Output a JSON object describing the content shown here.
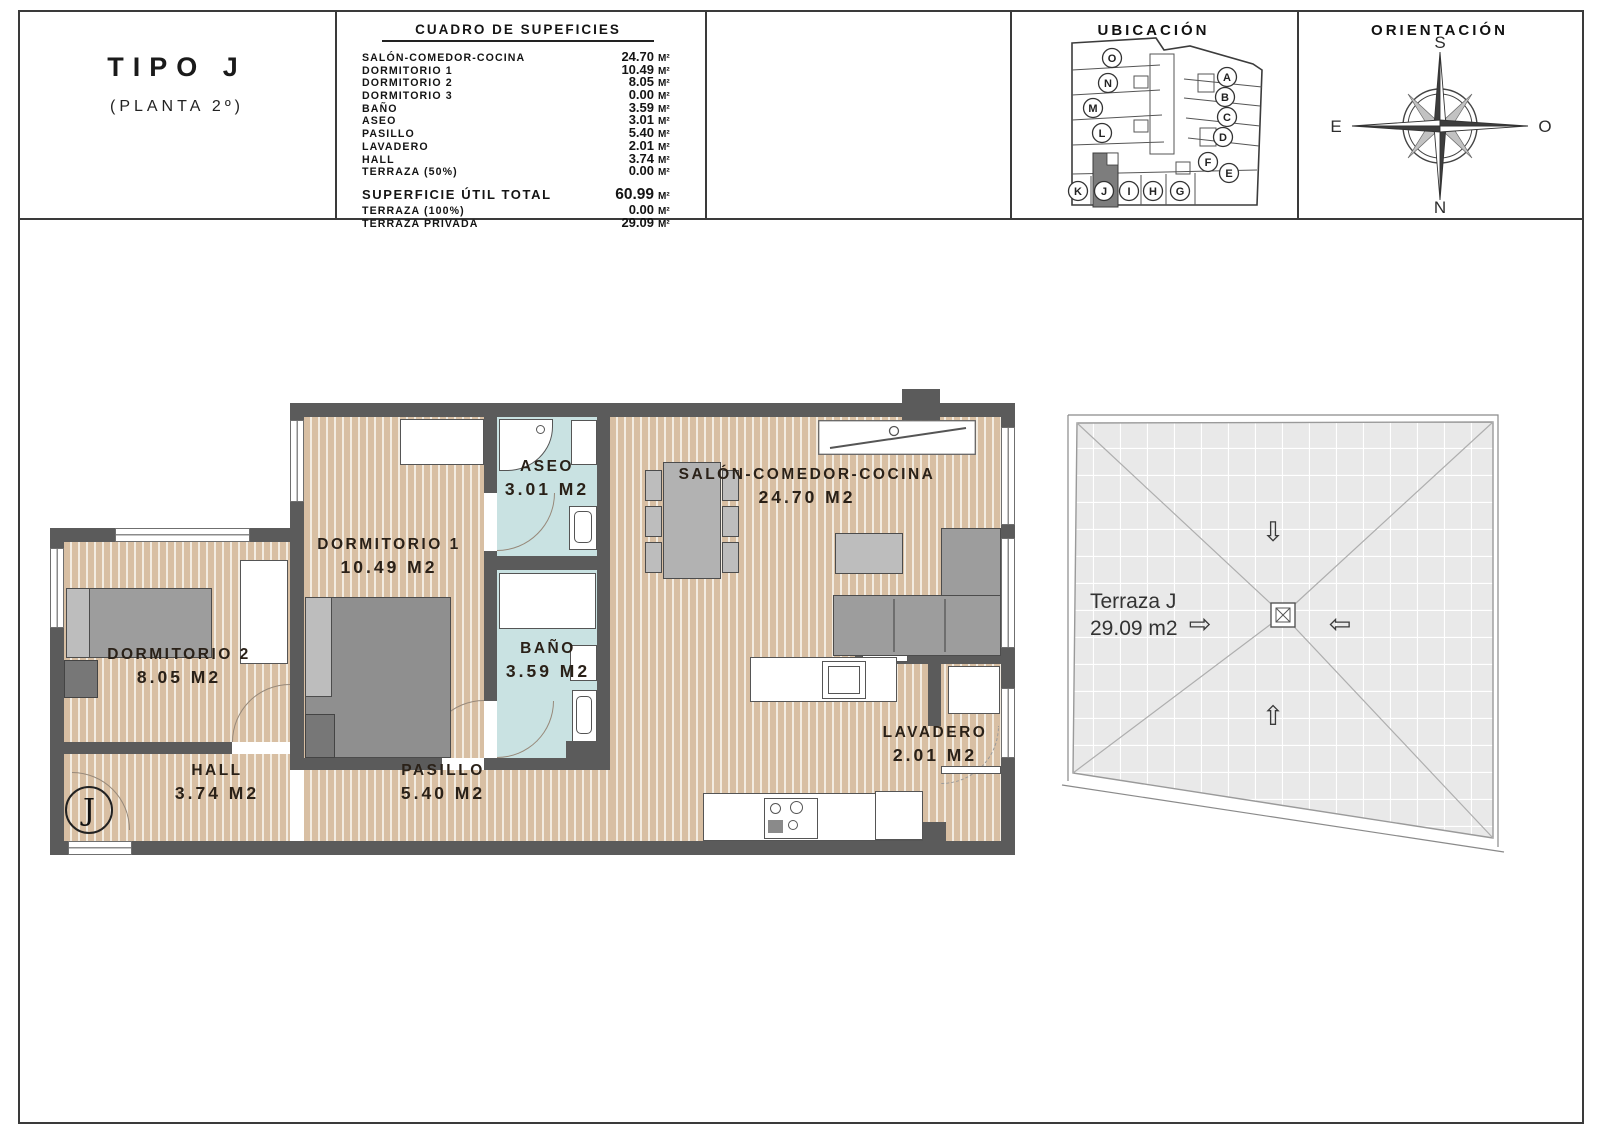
{
  "panels": {
    "type": {
      "title": "TIPO J",
      "subtitle": "(PLANTA 2º)"
    },
    "table": {
      "title": "CUADRO DE SUPEFICIES",
      "rows": [
        {
          "label": "SALÓN-COMEDOR-COCINA",
          "value": "24.70",
          "unit": "M²"
        },
        {
          "label": "DORMITORIO 1",
          "value": "10.49",
          "unit": "M²"
        },
        {
          "label": "DORMITORIO 2",
          "value": "8.05",
          "unit": "M²"
        },
        {
          "label": "DORMITORIO 3",
          "value": "0.00",
          "unit": "M²"
        },
        {
          "label": "BAÑO",
          "value": "3.59",
          "unit": "M²"
        },
        {
          "label": "ASEO",
          "value": "3.01",
          "unit": "M²"
        },
        {
          "label": "PASILLO",
          "value": "5.40",
          "unit": "M²"
        },
        {
          "label": "LAVADERO",
          "value": "2.01",
          "unit": "M²"
        },
        {
          "label": "HALL",
          "value": "3.74",
          "unit": "M²"
        },
        {
          "label": "TERRAZA (50%)",
          "value": "0.00",
          "unit": "M²"
        }
      ],
      "totals": [
        {
          "label": "SUPERFICIE ÚTIL TOTAL",
          "value": "60.99",
          "unit": "M²"
        },
        {
          "label": "TERRAZA (100%)",
          "value": "0.00",
          "unit": "M²"
        },
        {
          "label": "TERRAZA PRIVADA",
          "value": "29.09",
          "unit": "M²"
        }
      ]
    },
    "ubicacion": {
      "title": "UBICACIÓN",
      "units": [
        "O",
        "N",
        "M",
        "L",
        "A",
        "B",
        "C",
        "D",
        "F",
        "E",
        "K",
        "J",
        "I",
        "H",
        "G"
      ],
      "highlighted": "J"
    },
    "orientacion": {
      "title": "ORIENTACIÓN",
      "top": "S",
      "bottom": "N",
      "left": "E",
      "right": "O"
    }
  },
  "plan": {
    "rooms": [
      {
        "name": "SALÓN-COMEDOR-COCINA",
        "area": "24.70 M2"
      },
      {
        "name": "DORMITORIO 1",
        "area": "10.49 M2"
      },
      {
        "name": "DORMITORIO 2",
        "area": "8.05 M2"
      },
      {
        "name": "ASEO",
        "area": "3.01 M2"
      },
      {
        "name": "BAÑO",
        "area": "3.59 M2"
      },
      {
        "name": "PASILLO",
        "area": "5.40 M2"
      },
      {
        "name": "HALL",
        "area": "3.74 M2"
      },
      {
        "name": "LAVADERO",
        "area": "2.01 M2"
      }
    ],
    "badge": "J",
    "terrace": {
      "name": "Terraza J",
      "area": "29.09 m2"
    }
  },
  "colors": {
    "wall": "#5b5b5b",
    "wood_floor": "#d8bfa3",
    "bath_floor": "#c9e2e2",
    "terrace_tile": "#e9e9e9",
    "highlight_unit": "#7d7d7d"
  }
}
